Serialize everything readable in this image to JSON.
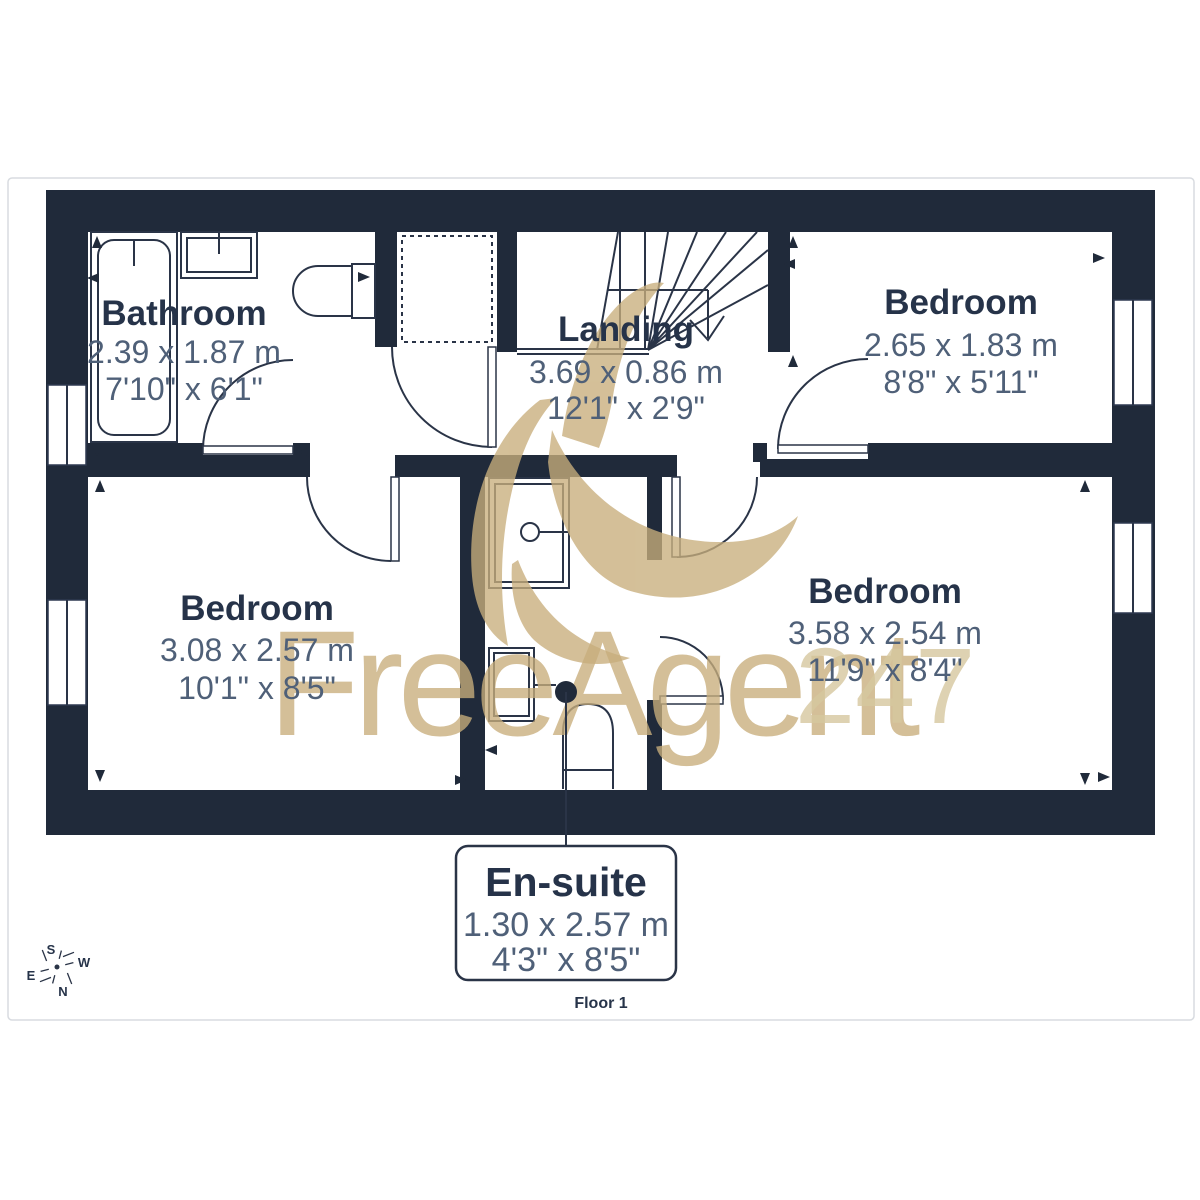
{
  "plan": {
    "floor_label": "Floor 1",
    "rooms": [
      {
        "id": "bathroom",
        "name": "Bathroom",
        "metric": "2.39 x 1.87 m",
        "imperial": "7'10\" x 6'1\""
      },
      {
        "id": "landing",
        "name": "Landing",
        "metric": "3.69 x 0.86 m",
        "imperial": "12'1\" x 2'9\""
      },
      {
        "id": "bedroom-tr",
        "name": "Bedroom",
        "metric": "2.65 x 1.83 m",
        "imperial": "8'8\" x 5'11\""
      },
      {
        "id": "bedroom-bl",
        "name": "Bedroom",
        "metric": "3.08 x 2.57 m",
        "imperial": "10'1\" x 8'5\""
      },
      {
        "id": "bedroom-br",
        "name": "Bedroom",
        "metric": "3.58 x 2.54 m",
        "imperial": "11'9\" x 8'4\""
      }
    ],
    "callout": {
      "name": "En-suite",
      "metric": "1.30 x 2.57 m",
      "imperial": "4'3\" x 8'5\""
    }
  },
  "compass": {
    "n": "N",
    "s": "S",
    "e": "E",
    "w": "W"
  },
  "watermark": {
    "brand": "FreeAgent",
    "suffix": "247"
  },
  "colors": {
    "wall": "#202a3a",
    "line": "#2a3447",
    "room_label": "#263349",
    "dimension_text": "#4f6078",
    "watermark_gold": "#c8ae7c",
    "frame": "#d8dbe0"
  }
}
